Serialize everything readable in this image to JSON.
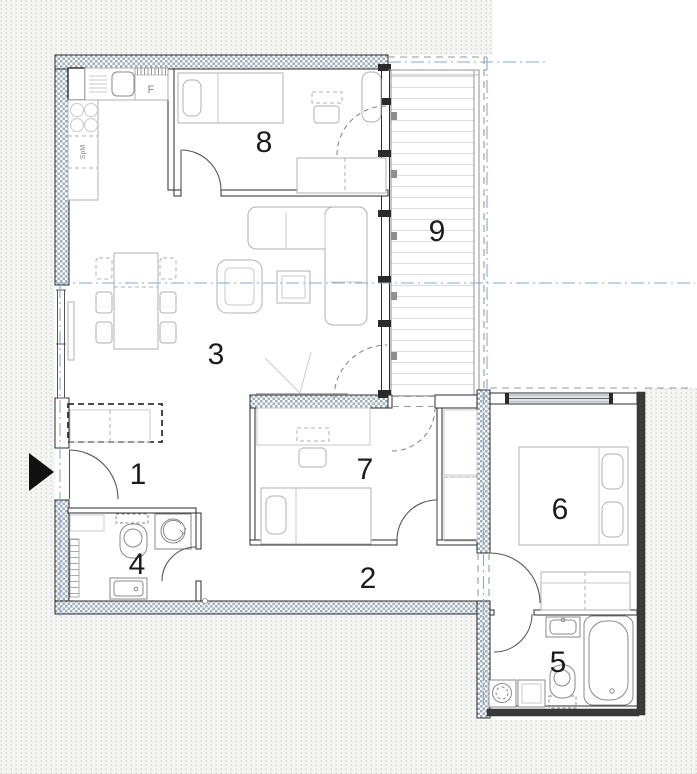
{
  "plan": {
    "title": "apartment-floor-plan",
    "rooms": [
      {
        "number": "1",
        "name": "entrance-hall"
      },
      {
        "number": "2",
        "name": "corridor"
      },
      {
        "number": "3",
        "name": "living-room"
      },
      {
        "number": "4",
        "name": "wc"
      },
      {
        "number": "5",
        "name": "bathroom"
      },
      {
        "number": "6",
        "name": "bedroom"
      },
      {
        "number": "7",
        "name": "bedroom-small"
      },
      {
        "number": "8",
        "name": "bedroom-kids"
      },
      {
        "number": "9",
        "name": "balcony"
      }
    ],
    "kitchen_labels": {
      "fridge": "F",
      "dishwasher": "SpM"
    },
    "colors": {
      "background_dots": "#d4d4d1",
      "wall_hatch": "#9eaebc",
      "wall_outline": "#2b2b2b",
      "dark_wall": "#3a3a3a",
      "centerline_blue": "#85a9d6",
      "furniture_gray": "#b2b2b2",
      "fixture_gray": "#8a8a8a",
      "label_color": "#1c1c1c"
    }
  }
}
